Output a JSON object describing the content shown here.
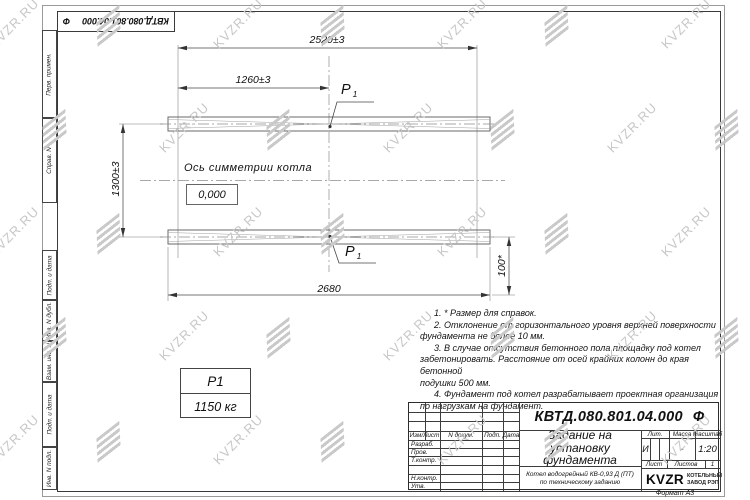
{
  "watermark": {
    "text": "KVZR.RU"
  },
  "format_label": "Формат А3",
  "top_stamp": {
    "designation": "КВТД.080.801.04.000",
    "suffix": "Ф"
  },
  "side_fields": [
    "Перв. примен.",
    "Справ. N",
    "Подп. и дата",
    "Инв. N дубл.",
    "Взам. инв. N",
    "Подп. и дата",
    "Инв. N подл."
  ],
  "drawing": {
    "dims": {
      "total_width": "2520±3",
      "half_width": "1260±3",
      "row_spacing": "1300±3",
      "beam_length": "2680",
      "edge_offset": "100*"
    },
    "axis_label": "Ось симметрии котла",
    "level_mark": "0,000",
    "load": {
      "symbol": "P",
      "sub": "1",
      "value": "1150 кг"
    }
  },
  "notes": {
    "lines": [
      "1. * Размер для справок.",
      "2. Отклонение от горизонтального уровня верхней поверхности",
      "фундамента не более 10 мм.",
      "3. В случае отсутствия бетонного пола площадку под котел",
      "забетонировать. Расстояние от осей крайних колонн до края бетонной",
      "подушки 500 мм.",
      "4. Фундамент под котел разрабатывает проектная организация",
      "по нагрузкам на фундамент."
    ]
  },
  "title_block": {
    "designation": "КВТД.080.801.04.000",
    "suffix": "Ф",
    "title_lines": [
      "Задание на",
      "установку",
      "фундамента"
    ],
    "product_lines": [
      "Котел водогрейный КВ-0,93 Д (ПТ)",
      "по техническому заданию"
    ],
    "change_header": [
      "Изм/Лист",
      "N докум.",
      "Подп.",
      "Дата"
    ],
    "role_rows": [
      "Разраб.",
      "Пров.",
      "Т.контр.",
      "Н.контр.",
      "Утв."
    ],
    "lit_label": "Лит.",
    "mass_label": "Масса",
    "scale_label": "Масштаб",
    "lit_value": "И",
    "mass_value": "-",
    "scale_value": "1:20",
    "sheet_label": "Лист",
    "sheets_label": "Листов",
    "sheets_value": "1",
    "logo_text": "KVZR",
    "company_line1": "КОТЕЛЬНЫЙ",
    "company_line2": "ЗАВОД РЭП"
  }
}
